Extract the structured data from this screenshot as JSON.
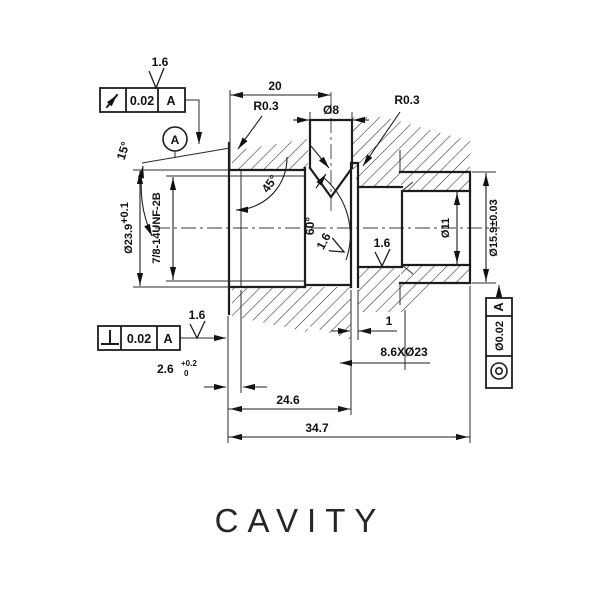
{
  "title": {
    "text": "CAVITY"
  },
  "datum": {
    "label": "A"
  },
  "fcf": {
    "runout": {
      "symbol": "circular-runout-icon",
      "tol": "0.02",
      "datum": "A"
    },
    "perp": {
      "symbol": "perpendicularity-icon",
      "tol": "0.02",
      "datum": "A"
    },
    "conc": {
      "symbol": "concentricity-icon",
      "tol": "Ø0.02",
      "datum": "A"
    }
  },
  "finish": {
    "ra": "1.6"
  },
  "dims": {
    "len20": "20",
    "dia8": "Ø8",
    "r03a": "R0.3",
    "r03b": "R0.3",
    "ang45": "45°",
    "ang60": "60°",
    "ang15": "15°",
    "dia239": "Ø23.9",
    "dia239_tol": "+0.1",
    "thread": "7/8-14UNF-2B",
    "dia11": "Ø11",
    "dia159": "Ø15.9±0.03",
    "d26": "2.6",
    "d26_tol_up": "+0.2",
    "d26_tol_low": "0",
    "d1": "1",
    "spotface": "8.6XØ23",
    "len246": "24.6",
    "len347": "34.7"
  }
}
